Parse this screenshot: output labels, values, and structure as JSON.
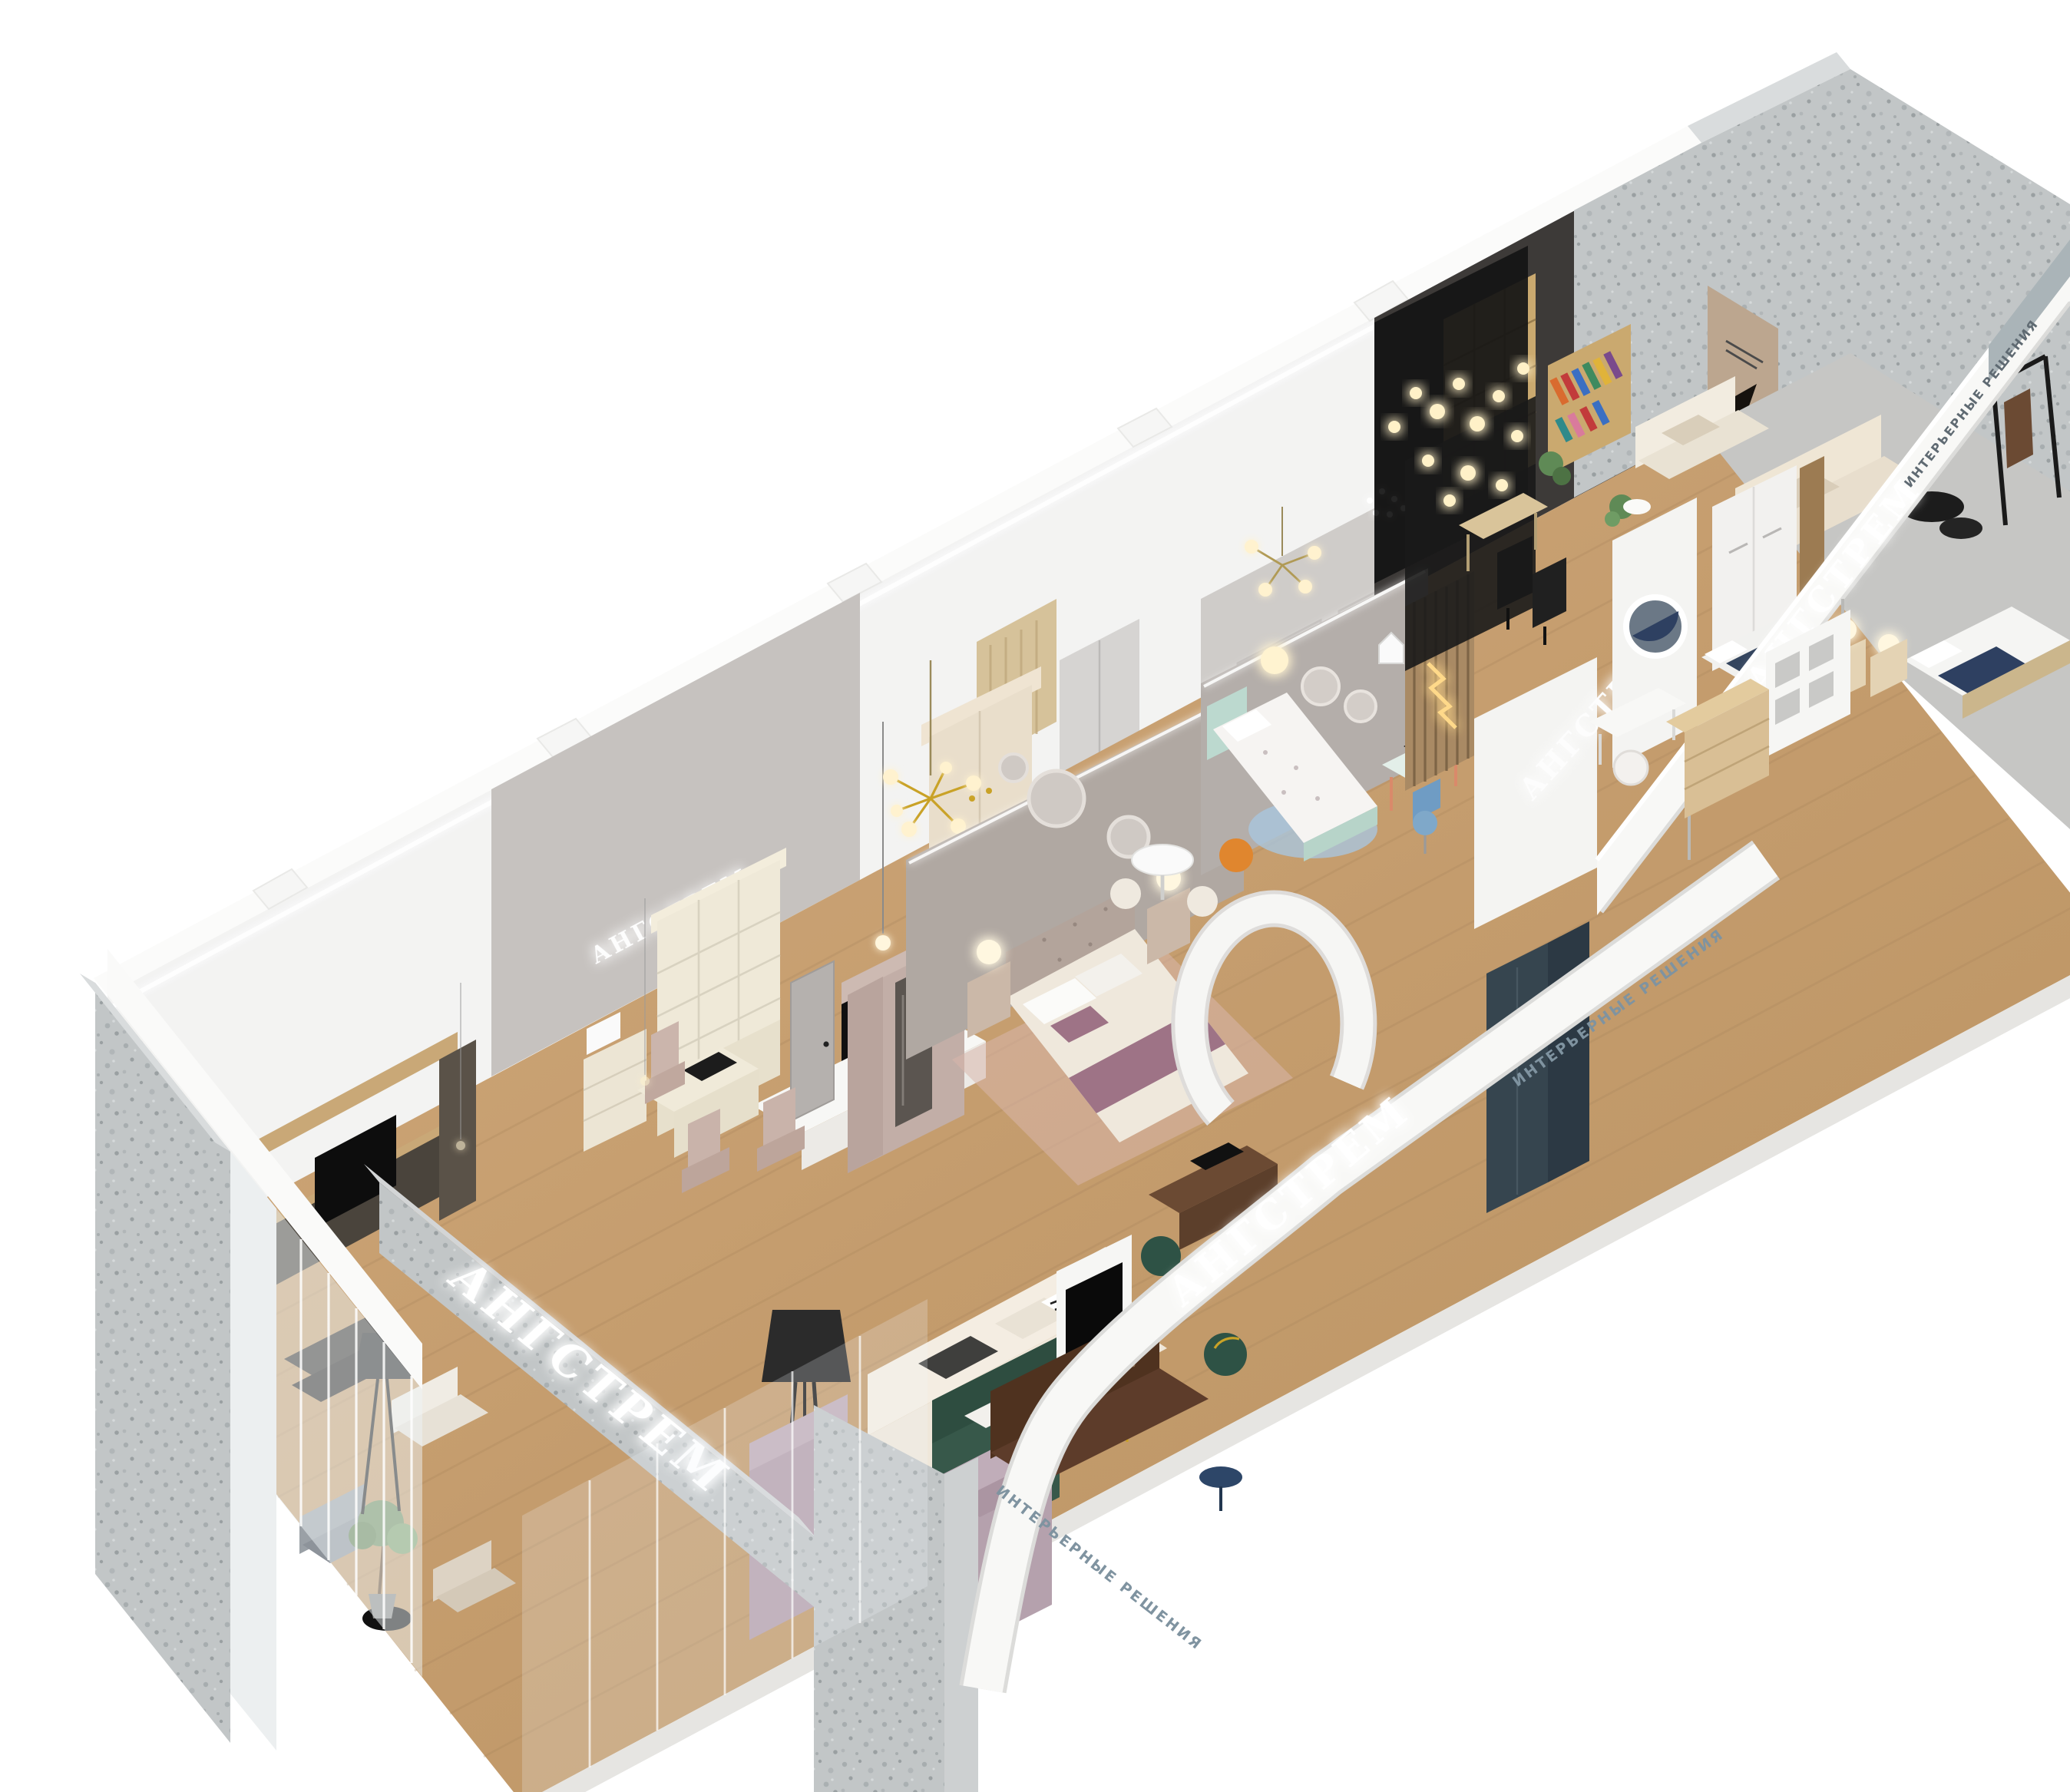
{
  "image": {
    "kind": "3d-isometric-cutaway-render",
    "subject": "furniture showroom floor visualization"
  },
  "brand": {
    "name": "АНГСТРЕМ",
    "tagline": "ИНТЕРЬЕРНЫЕ РЕШЕНИЯ"
  },
  "signs": [
    {
      "id": "beam-sign",
      "text": "АНГСТРЕМ",
      "surface": "granite beam, lower left"
    },
    {
      "id": "office-wall-sign",
      "text": "АНГСТРЕМ",
      "surface": "grey wall in study zone"
    },
    {
      "id": "bedroom-wall-sign",
      "text": "АНГСТРЕМ",
      "surface": "white partition, centre-right"
    },
    {
      "id": "central-balustrade-sign",
      "text": "АНГСТРЕМ",
      "surface": "white balustrade, centre"
    },
    {
      "id": "right-balustrade-sign",
      "text": "АНГСТРЕМ",
      "surface": "white balustrade, right"
    },
    {
      "id": "central-balustrade-tagline",
      "text": "ИНТЕРЬЕРНЫЕ РЕШЕНИЯ",
      "surface": "white balustrade small print"
    },
    {
      "id": "right-balustrade-tagline",
      "text": "ИНТЕРЬЕРНЫЕ РЕШЕНИЯ",
      "surface": "escalator balustrade small print"
    }
  ],
  "palette": {
    "background": "#ffffff",
    "concrete": "#c2c6c7",
    "wall_white": "#f3f3f2",
    "wall_grey": "#bab6b3",
    "floor_wood": "#c9a376",
    "sofa_cream": "#efe7da",
    "sofa_lilac": "#b5a1ad",
    "sofa_green": "#37584a",
    "sofa_brown": "#5d3c2a",
    "bed_mauve": "#9e7386",
    "bed_navy": "#2e4061",
    "kids_mint": "#b7d4c9",
    "accent_gold": "#c9a227",
    "dark_glass": "#141414",
    "sign_glow": "#ffffff"
  }
}
